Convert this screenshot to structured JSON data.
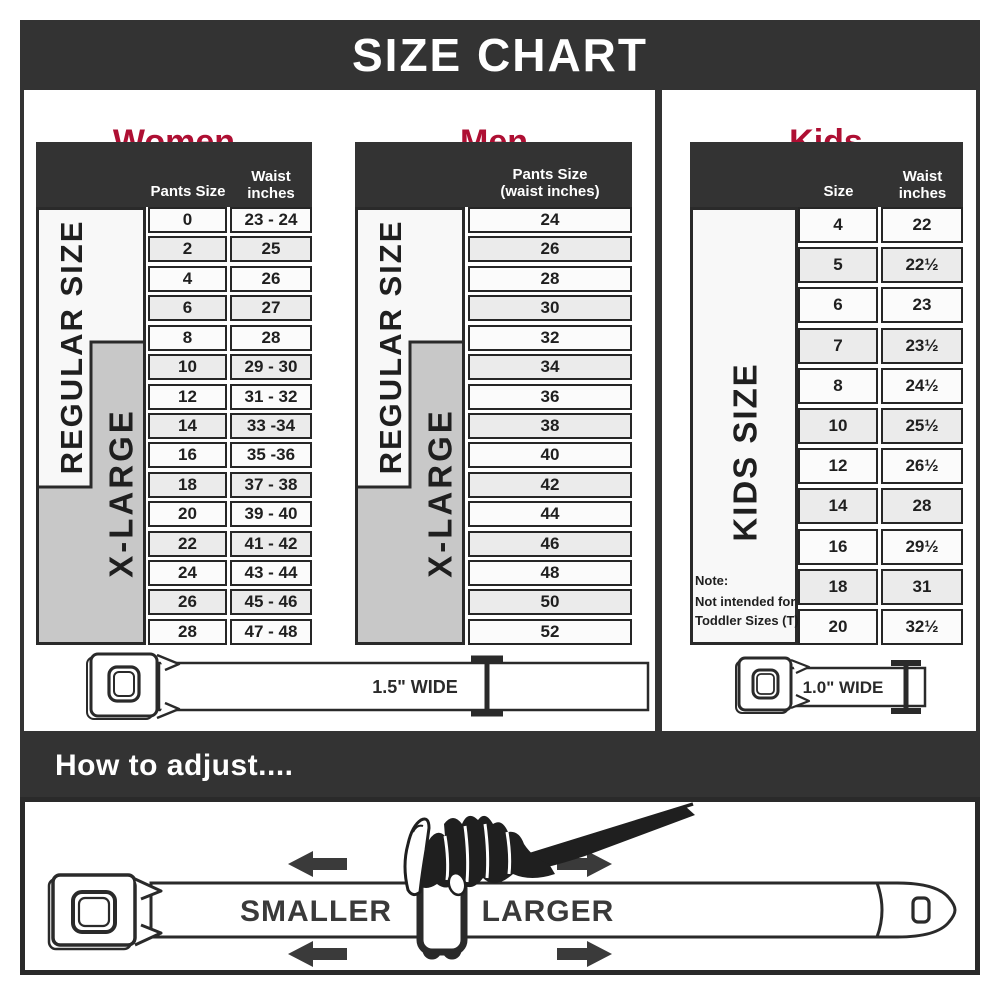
{
  "title": "SIZE CHART",
  "colors": {
    "dark_bar": "#333333",
    "accent_red": "#ae0f33",
    "cell_border": "#262626",
    "row_white": "#fbfbfb",
    "row_alt_gray": "#ebebeb",
    "xlarge_gray": "#c8c8c8",
    "label_white": "#f8f8f8",
    "arrow_gray": "#3a3a3a"
  },
  "women": {
    "heading": "Women",
    "col1_header": "Pants Size",
    "col2_header_line1": "Waist",
    "col2_header_line2": "inches",
    "regular_label": "REGULAR SIZE",
    "xlarge_label": "X-LARGE",
    "rows": [
      {
        "size": "0",
        "waist": "23 - 24"
      },
      {
        "size": "2",
        "waist": "25"
      },
      {
        "size": "4",
        "waist": "26"
      },
      {
        "size": "6",
        "waist": "27"
      },
      {
        "size": "8",
        "waist": "28"
      },
      {
        "size": "10",
        "waist": "29 - 30"
      },
      {
        "size": "12",
        "waist": "31 - 32"
      },
      {
        "size": "14",
        "waist": "33 -34"
      },
      {
        "size": "16",
        "waist": "35 -36"
      },
      {
        "size": "18",
        "waist": "37 - 38"
      },
      {
        "size": "20",
        "waist": "39 - 40"
      },
      {
        "size": "22",
        "waist": "41 - 42"
      },
      {
        "size": "24",
        "waist": "43 - 44"
      },
      {
        "size": "26",
        "waist": "45 - 46"
      },
      {
        "size": "28",
        "waist": "47 - 48"
      }
    ]
  },
  "men": {
    "heading": "Men",
    "col_header_line1": "Pants Size",
    "col_header_line2": "(waist inches)",
    "regular_label": "REGULAR SIZE",
    "xlarge_label": "X-LARGE",
    "rows": [
      "24",
      "26",
      "28",
      "30",
      "32",
      "34",
      "36",
      "38",
      "40",
      "42",
      "44",
      "46",
      "48",
      "50",
      "52"
    ]
  },
  "kids": {
    "heading": "Kids",
    "col1_header": "Size",
    "col2_header_line1": "Waist",
    "col2_header_line2": "inches",
    "side_label": "KIDS SIZE",
    "note_line1": "Note:",
    "note_line2": "Not intended for",
    "note_line3": "Toddler Sizes (T)",
    "rows": [
      {
        "size": "4",
        "waist": "22"
      },
      {
        "size": "5",
        "waist": "22½"
      },
      {
        "size": "6",
        "waist": "23"
      },
      {
        "size": "7",
        "waist": "23½"
      },
      {
        "size": "8",
        "waist": "24½"
      },
      {
        "size": "10",
        "waist": "25½"
      },
      {
        "size": "12",
        "waist": "26½"
      },
      {
        "size": "14",
        "waist": "28"
      },
      {
        "size": "16",
        "waist": "29½"
      },
      {
        "size": "18",
        "waist": "31"
      },
      {
        "size": "20",
        "waist": "32½"
      }
    ]
  },
  "belts": {
    "adult_width_label": "1.5\" WIDE",
    "kids_width_label": "1.0\" WIDE"
  },
  "adjust": {
    "heading": "How to adjust....",
    "smaller_label": "SMALLER",
    "larger_label": "LARGER"
  },
  "chart_data": [
    {
      "type": "table",
      "title": "Women",
      "columns": [
        "Pants Size",
        "Waist inches"
      ],
      "rows": [
        [
          "0",
          "23 - 24"
        ],
        [
          "2",
          "25"
        ],
        [
          "4",
          "26"
        ],
        [
          "6",
          "27"
        ],
        [
          "8",
          "28"
        ],
        [
          "10",
          "29 - 30"
        ],
        [
          "12",
          "31 - 32"
        ],
        [
          "14",
          "33 -34"
        ],
        [
          "16",
          "35 -36"
        ],
        [
          "18",
          "37 - 38"
        ],
        [
          "20",
          "39 - 40"
        ],
        [
          "22",
          "41 - 42"
        ],
        [
          "24",
          "43 - 44"
        ],
        [
          "26",
          "45 - 46"
        ],
        [
          "28",
          "47 - 48"
        ]
      ],
      "groups": [
        {
          "label": "REGULAR SIZE",
          "from_size": "0",
          "to_size": "18"
        },
        {
          "label": "X-LARGE",
          "from_size": "10",
          "to_size": "28"
        }
      ]
    },
    {
      "type": "table",
      "title": "Men",
      "columns": [
        "Pants Size (waist inches)"
      ],
      "rows": [
        [
          "24"
        ],
        [
          "26"
        ],
        [
          "28"
        ],
        [
          "30"
        ],
        [
          "32"
        ],
        [
          "34"
        ],
        [
          "36"
        ],
        [
          "38"
        ],
        [
          "40"
        ],
        [
          "42"
        ],
        [
          "44"
        ],
        [
          "46"
        ],
        [
          "48"
        ],
        [
          "50"
        ],
        [
          "52"
        ]
      ],
      "groups": [
        {
          "label": "REGULAR SIZE",
          "from_size": "24",
          "to_size": "42"
        },
        {
          "label": "X-LARGE",
          "from_size": "34",
          "to_size": "52"
        }
      ]
    },
    {
      "type": "table",
      "title": "Kids",
      "columns": [
        "Size",
        "Waist inches"
      ],
      "rows": [
        [
          "4",
          "22"
        ],
        [
          "5",
          "22½"
        ],
        [
          "6",
          "23"
        ],
        [
          "7",
          "23½"
        ],
        [
          "8",
          "24½"
        ],
        [
          "10",
          "25½"
        ],
        [
          "12",
          "26½"
        ],
        [
          "14",
          "28"
        ],
        [
          "16",
          "29½"
        ],
        [
          "18",
          "31"
        ],
        [
          "20",
          "32½"
        ]
      ],
      "groups": [
        {
          "label": "KIDS SIZE",
          "from_size": "4",
          "to_size": "20"
        }
      ],
      "note": "Note: Not intended for Toddler Sizes (T)"
    }
  ]
}
